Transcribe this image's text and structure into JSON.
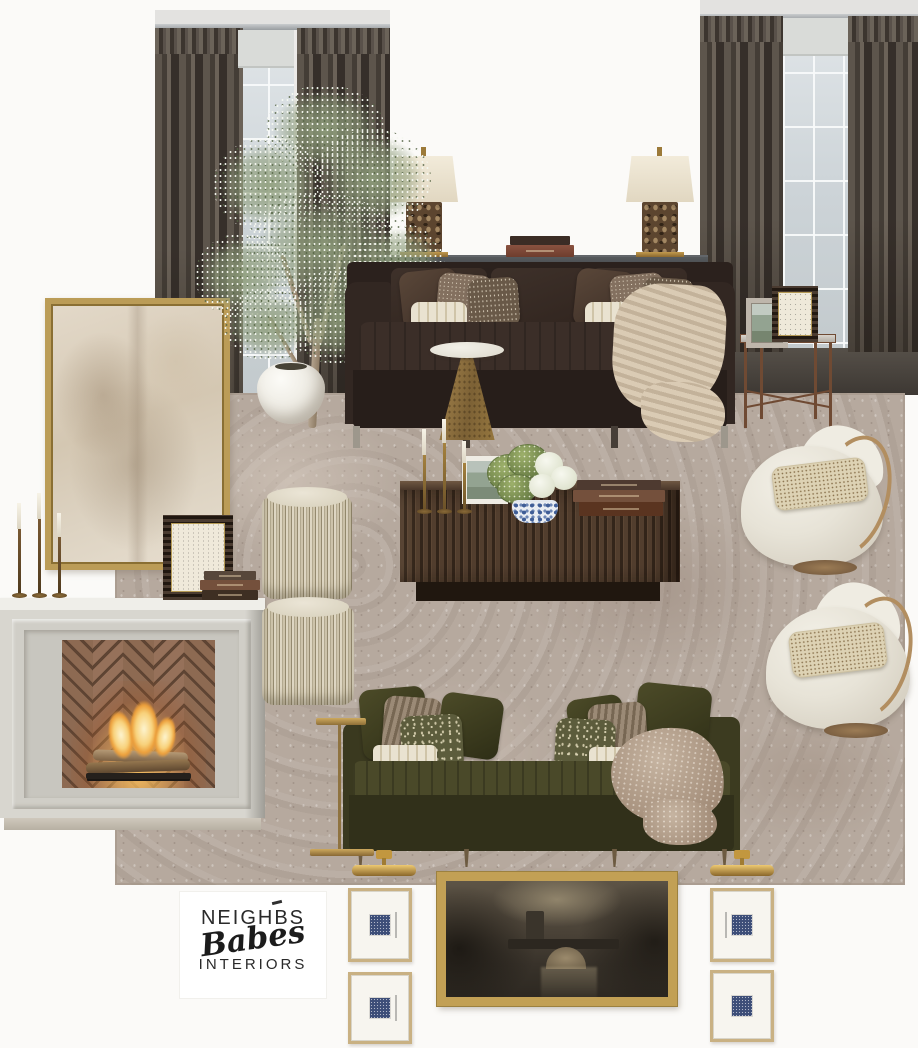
{
  "board": {
    "title": "Living room mood board",
    "background": "#fbfaf8"
  },
  "logo": {
    "line1": "NEIGHBS",
    "line2": "Babes",
    "line3": "INTERIORS"
  },
  "palette": {
    "curtain_taupe": "#574f47",
    "window_glass": "#ccd3d8",
    "area_rug_taupe": "#b5a89d",
    "espresso_sofa": "#342a25",
    "olive_sofa": "#3c3b21",
    "charcoal_console": "#43474b",
    "fluted_walnut": "#46342a",
    "brass": "#b08d4d",
    "gold_frame": "#bb9c57",
    "ivory_boucle": "#e9e5da",
    "limestone_mantel": "#d9d7d0",
    "fire_glow": "#f4b04b",
    "navy_print": "#3d4e78",
    "logo_ink": "#1f1f1f"
  },
  "items": [
    {
      "name": "left-window",
      "desc": "Window with dark taupe pinch-pleat curtain panels"
    },
    {
      "name": "right-window",
      "desc": "Window with dark taupe pinch-pleat curtain panels"
    },
    {
      "name": "olive-tree",
      "desc": "Faux olive tree in white belly planter"
    },
    {
      "name": "table-lamp-left",
      "desc": "Cream drum-shade lamp with brown marble base"
    },
    {
      "name": "table-lamp-right",
      "desc": "Cream drum-shade lamp with brown marble base"
    },
    {
      "name": "console-books",
      "desc": "Stack of two books"
    },
    {
      "name": "charcoal-console",
      "desc": "Charcoal sofa-back console"
    },
    {
      "name": "espresso-sofa",
      "desc": "Espresso velvet sofa with pillows and chunky knit throw"
    },
    {
      "name": "brass-cone-table",
      "desc": "Brass cone accent table with stone top"
    },
    {
      "name": "abstract-art",
      "desc": "Gold-framed neutral abstract painting"
    },
    {
      "name": "mantel-candlesticks",
      "desc": "Trio of bronze taper candlesticks"
    },
    {
      "name": "horn-frame-mantel",
      "desc": "Dark horn photo frame with script print"
    },
    {
      "name": "mantel-books",
      "desc": "Stack of vintage books"
    },
    {
      "name": "fireplace",
      "desc": "Limestone mantel with herringbone brick firebox and lit fire"
    },
    {
      "name": "fringe-ottoman-top",
      "desc": "Cream fringed stool"
    },
    {
      "name": "fringe-ottoman-bottom",
      "desc": "Cream fringed stool"
    },
    {
      "name": "area-rug",
      "desc": "Vintage-wash taupe oriental rug"
    },
    {
      "name": "taper-candlesticks",
      "desc": "Brass taper candlesticks with cream candles"
    },
    {
      "name": "fluted-sideboard",
      "desc": "Fluted walnut media console"
    },
    {
      "name": "small-photo-frame",
      "desc": "Stone frame with landscape photo"
    },
    {
      "name": "hydrangea-arrangement",
      "desc": "Green and white hydrangeas in blue ginger jar"
    },
    {
      "name": "sideboard-books",
      "desc": "Stack of three books"
    },
    {
      "name": "bronze-side-table",
      "desc": "Hammered bronze side table"
    },
    {
      "name": "marble-photo-frame",
      "desc": "Stone picture frame with landscape photo"
    },
    {
      "name": "horn-frame-botanical",
      "desc": "Horn picture frame with botanical print"
    },
    {
      "name": "swivel-chair-top",
      "desc": "Ivory barrel swivel chair with tan leather trim and speckled lumbar pillow"
    },
    {
      "name": "swivel-chair-bottom",
      "desc": "Ivory barrel swivel chair with tan leather trim and speckled lumbar pillow"
    },
    {
      "name": "olive-sofa",
      "desc": "Olive velvet sofa with block-print pillows and sheepskin throw"
    },
    {
      "name": "brass-c-table",
      "desc": "Slim brass C-shaped side table"
    },
    {
      "name": "picture-light-left",
      "desc": "Brass picture light"
    },
    {
      "name": "picture-light-right",
      "desc": "Brass picture light"
    },
    {
      "name": "gallery-frame-1",
      "desc": "Gold gallery frame with navy mini print"
    },
    {
      "name": "gallery-frame-2",
      "desc": "Gold gallery frame with navy mini print"
    },
    {
      "name": "gallery-frame-3",
      "desc": "Gold gallery frame with navy mini print"
    },
    {
      "name": "gallery-frame-4",
      "desc": "Gold gallery frame with navy mini print"
    },
    {
      "name": "bridge-painting",
      "desc": "Gold-framed moody landscape painting with stone bridge"
    },
    {
      "name": "brand-logo",
      "desc": "Neighbs Babes Interiors wordmark"
    }
  ]
}
